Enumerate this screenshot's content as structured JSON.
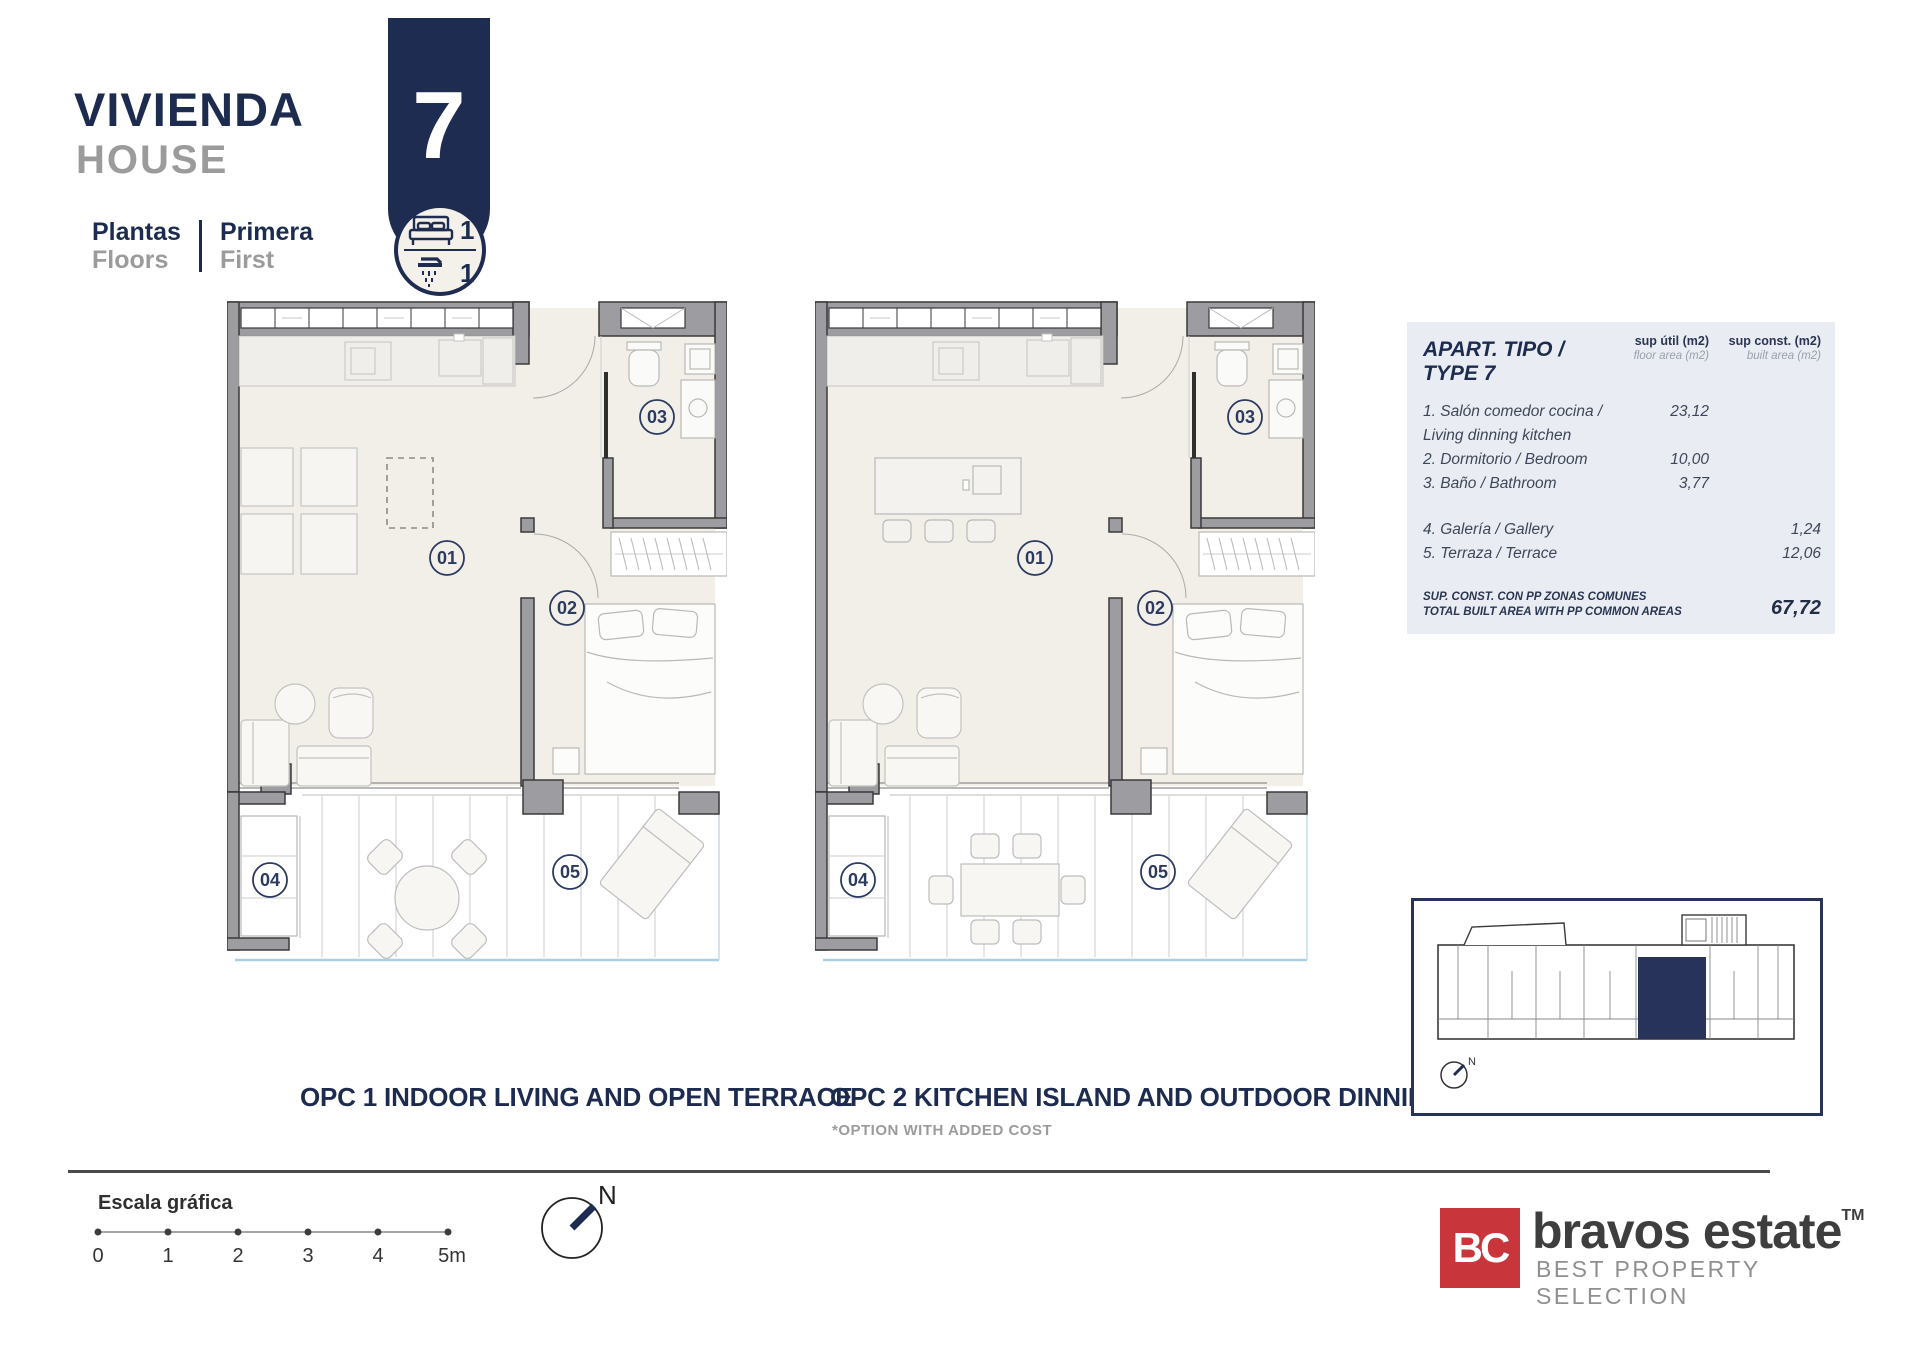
{
  "header": {
    "title_es": "VIVIENDA",
    "title_en": "HOUSE",
    "floors_label_es": "Plantas",
    "floors_label_en": "Floors",
    "floor_value_es": "Primera",
    "floor_value_en": "First",
    "house_number": "7",
    "bedrooms_count": "1",
    "bathrooms_count": "1"
  },
  "area_table": {
    "title": "APART. TIPO / TYPE 7",
    "col1_label": "sup útil (m2)",
    "col1_sublabel": "floor area (m2)",
    "col2_label": "sup const. (m2)",
    "col2_sublabel": "built area (m2)",
    "rows": [
      {
        "label": "1. Salón comedor cocina / Living dinning kitchen",
        "floor_area": "23,12",
        "built_area": ""
      },
      {
        "label": "2. Dormitorio / Bedroom",
        "floor_area": "10,00",
        "built_area": ""
      },
      {
        "label": "3. Baño / Bathroom",
        "floor_area": "3,77",
        "built_area": ""
      },
      {
        "label": "4. Galería / Gallery",
        "floor_area": "",
        "built_area": "1,24"
      },
      {
        "label": "5. Terraza / Terrace",
        "floor_area": "",
        "built_area": "12,06"
      }
    ],
    "total_label_es": "SUP. CONST. CON PP ZONAS COMUNES",
    "total_label_en": "TOTAL BUILT AREA WITH PP COMMON AREAS",
    "total_value": "67,72"
  },
  "plans": {
    "room_labels": [
      "01",
      "02",
      "03",
      "04",
      "05"
    ],
    "opc1_title": "OPC 1 INDOOR LIVING AND OPEN TERRACE",
    "opc2_title": "OPC 2 KITCHEN ISLAND AND OUTDOOR DINNING",
    "opc2_note": "*OPTION WITH ADDED COST"
  },
  "scale_bar": {
    "label": "Escala gráfica",
    "ticks": [
      "0",
      "1",
      "2",
      "3",
      "4",
      "5m"
    ]
  },
  "compass": {
    "north_label": "N"
  },
  "minimap": {
    "north_label": "N"
  },
  "logo": {
    "monogram": "BC",
    "name": "bravos estate",
    "tm": "TM",
    "tagline": "BEST PROPERTY SELECTION"
  },
  "colors": {
    "navy": "#1f2c52",
    "title_gray": "#9b9b9b",
    "wall_gray": "#9c9ca1",
    "floor_beige": "#f2efe9",
    "glass_blue": "#a9cfe0",
    "table_bg": "#e9edf3",
    "logo_red": "#c8363c"
  }
}
